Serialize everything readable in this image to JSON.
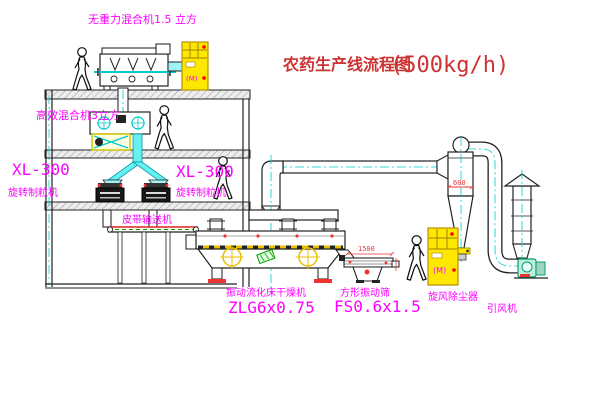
{
  "title": {
    "text": "农药生产线流程图",
    "capacity": "(500kg/h)"
  },
  "labels": {
    "top_mixer": "无重力混合机1.5 立方",
    "mid_mixer": "高效混合机3立方",
    "granulator_model_left": "XL-300",
    "granulator_name_left": "旋转制粒机",
    "granulator_model_right": "XL-300",
    "granulator_name_right": "旋转制粒机",
    "belt_conveyor": "皮带输送机",
    "dryer_name": "振动流化床干燥机",
    "dryer_model": "ZLG6x0.75",
    "screen_name": "方形振动筛",
    "screen_model": "FS0.6x1.5",
    "cyclone": "旋风除尘器",
    "induced_draft_fan": "引风机",
    "motor_symbol": "(M)"
  },
  "dimensions": {
    "screen_length": "1500",
    "cyclone_diameter": "600"
  },
  "colors": {
    "label_magenta": "#ff00ff",
    "title_red": "#cc3333",
    "dimension_red": "#ee3333",
    "centerline_cyan": "#00cccc",
    "cabinet_yellow": "#ffe800",
    "chute_cyan": "#66f0f0"
  }
}
